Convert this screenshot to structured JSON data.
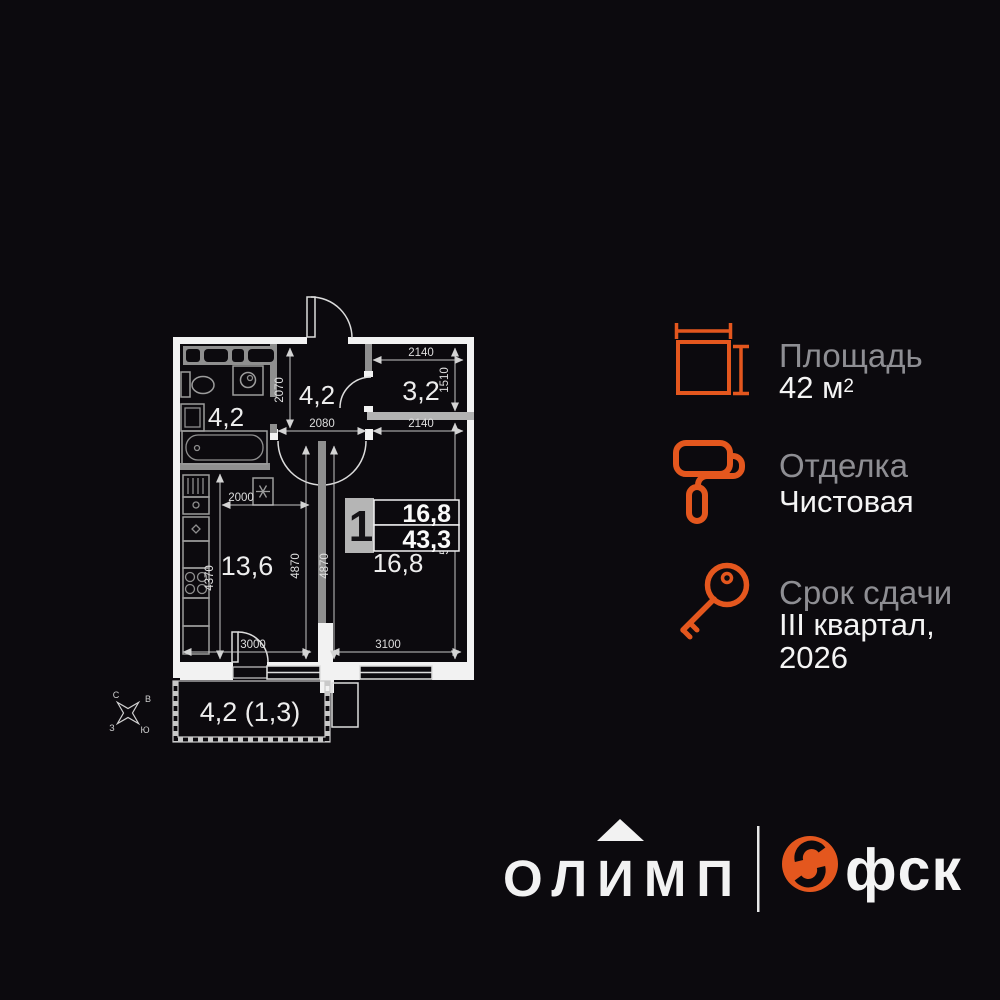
{
  "colors": {
    "accent": "#E4571E",
    "background": "#0C0A0E",
    "label_gray": "#8E8E93",
    "wall_white": "#F2F2F2"
  },
  "plan": {
    "rooms": {
      "bathroom": "4,2",
      "hallway": "4,2",
      "storage": "3,2",
      "kitchen": "13,6",
      "living": "16,8",
      "balcony": "4,2 (1,3)"
    },
    "dims": {
      "d2140a": "2140",
      "d1510": "1510",
      "d2070": "2070",
      "d2080": "2080",
      "d2140b": "2140",
      "d2000": "2000",
      "d4370": "4370",
      "d4870a": "4870",
      "d4870b": "4870",
      "d5430": "5430",
      "d3000": "3000",
      "d3100": "3100"
    },
    "info_box": {
      "rooms": "1",
      "living_area": "16,8",
      "total_area": "43,3",
      "room_label": "16,8"
    },
    "compass": {
      "n": "С",
      "e": "В",
      "w": "З",
      "s": "Ю"
    }
  },
  "details": [
    {
      "icon": "area-icon",
      "label": "Площадь",
      "value": "42 м",
      "sup": "2"
    },
    {
      "icon": "paint-roller-icon",
      "label": "Отделка",
      "value": "Чистовая"
    },
    {
      "icon": "key-icon",
      "label": "Срок сдачи",
      "value_line1": "III квартал,",
      "value_line2": "2026"
    }
  ],
  "footer": {
    "brand": "олимп",
    "developer": "фск"
  }
}
